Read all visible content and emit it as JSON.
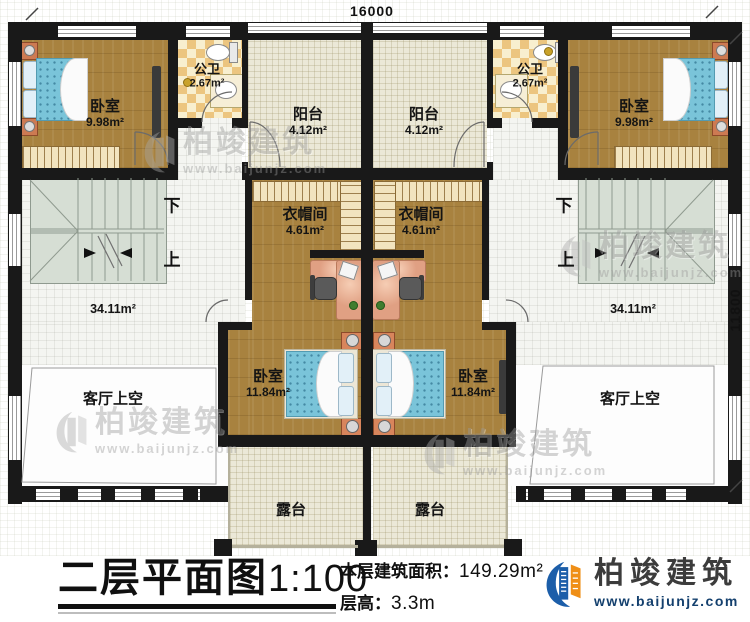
{
  "dimensions": {
    "width": "16000",
    "height": "11800"
  },
  "stairs": {
    "down": "下",
    "up": "上"
  },
  "rooms": {
    "bedroom_tl": {
      "name": "卧室",
      "area": "9.98m²"
    },
    "bath_l": {
      "name": "公卫",
      "area": "2.67m²"
    },
    "balcony_l": {
      "name": "阳台",
      "area": "4.12m²"
    },
    "balcony_r": {
      "name": "阳台",
      "area": "4.12m²"
    },
    "bath_r": {
      "name": "公卫",
      "area": "2.67m²"
    },
    "bedroom_tr": {
      "name": "卧室",
      "area": "9.98m²"
    },
    "cloak_l": {
      "name": "衣帽间",
      "area": "4.61m²"
    },
    "cloak_r": {
      "name": "衣帽间",
      "area": "4.61m²"
    },
    "bedroom_bl": {
      "name": "卧室",
      "area": "11.84m²"
    },
    "bedroom_br": {
      "name": "卧室",
      "area": "11.84m²"
    },
    "hall_l": {
      "area": "34.11m²"
    },
    "hall_r": {
      "area": "34.11m²"
    },
    "void_l": {
      "name": "客厅上空"
    },
    "void_r": {
      "name": "客厅上空"
    },
    "terrace_l": {
      "name": "露台"
    },
    "terrace_r": {
      "name": "露台"
    }
  },
  "titleblock": {
    "title": "二层平面图",
    "scale": "1:100",
    "area_label": "本层建筑面积：",
    "area_value": "149.29m²",
    "height_label": "层高：",
    "height_value": "3.3m"
  },
  "logo": {
    "name": "柏竣建筑",
    "url": "www.baijunjz.com"
  },
  "watermark": {
    "name": "柏竣建筑",
    "url": "www.baijunjz.com"
  },
  "colors": {
    "wall": "#191919",
    "wood_floor": "#a8823f",
    "bath_tile": "#ecc57f",
    "balcony_floor": "#ebe8d7",
    "stair_floor": "#d6ded4",
    "bed_blue": "#7ac4d9",
    "desk_salmon": "#e0a083",
    "logo_blue": "#1c5ea9",
    "logo_orange": "#ef8f17"
  }
}
